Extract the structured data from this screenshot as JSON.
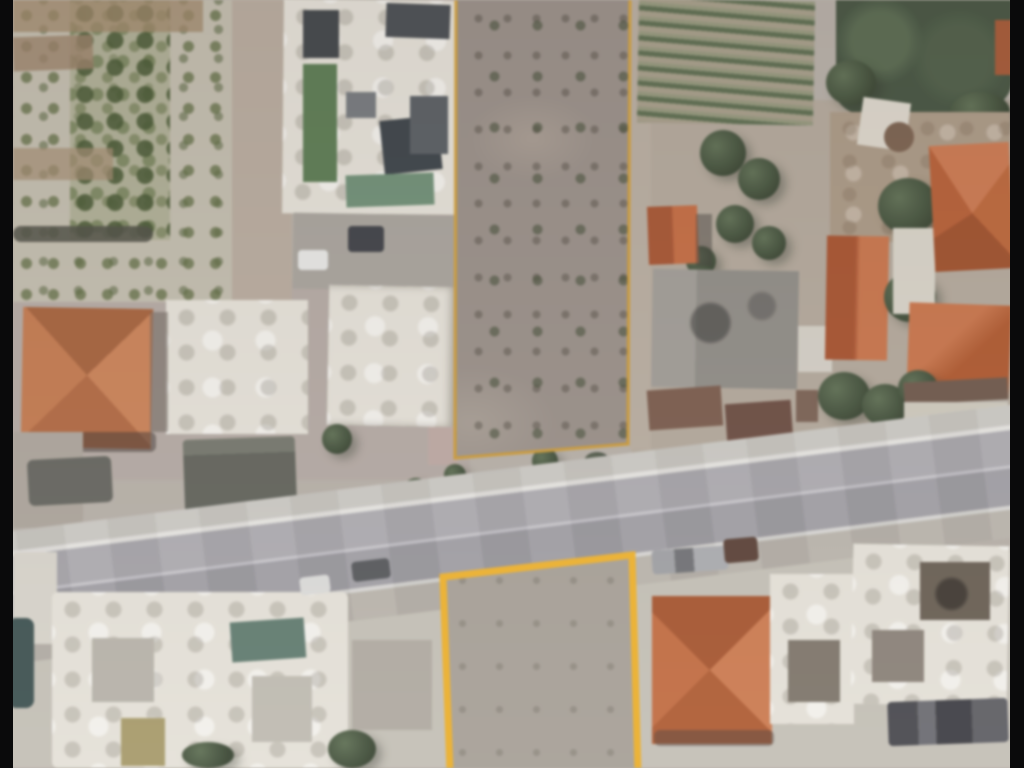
{
  "scene": {
    "type": "aerial-satellite-photo",
    "description": "Blurry aerial satellite view of a village street. Two vacant land parcels are highlighted with orange outlines: a long narrow scrubland parcel above the road and a rectangular dirt parcel below it. Surroundings include orange tiled-roof houses, white flat-roofed buildings, an olive grove, a vineyard, tree clusters and a diagonal two-lane road. Black letterbox bars run down the left and right edges."
  },
  "parcels": {
    "top": {
      "label": "upper highlighted parcel",
      "points": "456,-6 630,-6 628,444 455,458"
    },
    "bottom": {
      "label": "lower highlighted parcel",
      "points": "443,577 632,555 638,772 450,772"
    }
  },
  "colors": {
    "parcel_top_stroke": "#CE9C3A",
    "parcel_bottom_stroke": "#F0B431",
    "bar": "#0a0a0b",
    "ground": "#b5aea6",
    "scrub": "#998e87",
    "dirt": "#a7a096",
    "asphalt": "#a8a6ab",
    "sidewalk": "#c9c6c0",
    "roof_orange": "#c4754a",
    "roof_orange_deep": "#b85c30",
    "roof_white": "#e6e2d8",
    "tree_dark": "#36432f",
    "tree_mid": "#5c6e50",
    "grove": "#c3bdad",
    "pool": "#6d8f74",
    "panel": "#3f4347",
    "lawn": "#587a4f",
    "teal": "#5e7a6e",
    "khaki": "#a89a66"
  }
}
